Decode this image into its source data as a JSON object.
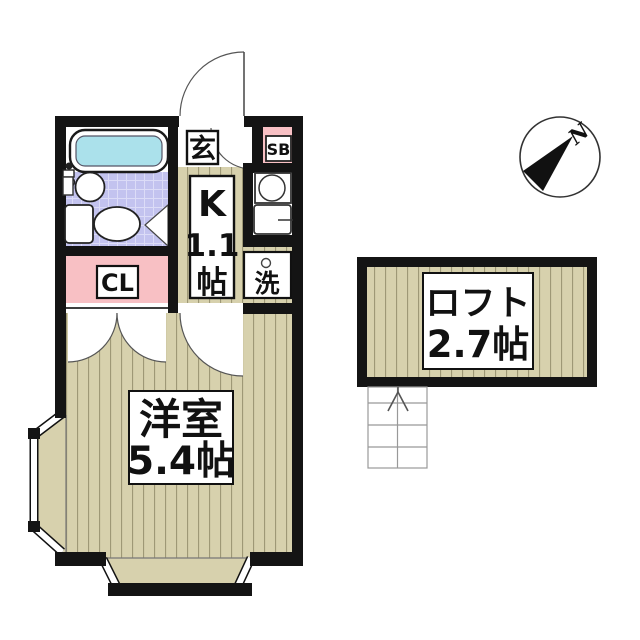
{
  "plan": {
    "entrance": {
      "label": "玄"
    },
    "shoe_box": {
      "label": "SB"
    },
    "kitchen": {
      "label_lines": [
        "K",
        "1.1",
        "帖"
      ]
    },
    "closet": {
      "label": "CL"
    },
    "laundry": {
      "label": "洗"
    },
    "main_room": {
      "label_lines": [
        "洋室",
        "5.4帖"
      ]
    },
    "loft": {
      "label_lines": [
        "ロフト",
        "2.7帖"
      ]
    },
    "compass": {
      "north_label": "N"
    }
  },
  "colors": {
    "wall": "#141414",
    "floor": "#d7d1ad",
    "stripe": "#97926f",
    "tile": "#c3c3ef",
    "tile_line": "#dcdcf7",
    "pink": "#f8c0c4",
    "cyan": "#abe1eb",
    "line": "#333333",
    "paper": "#ffffff"
  }
}
